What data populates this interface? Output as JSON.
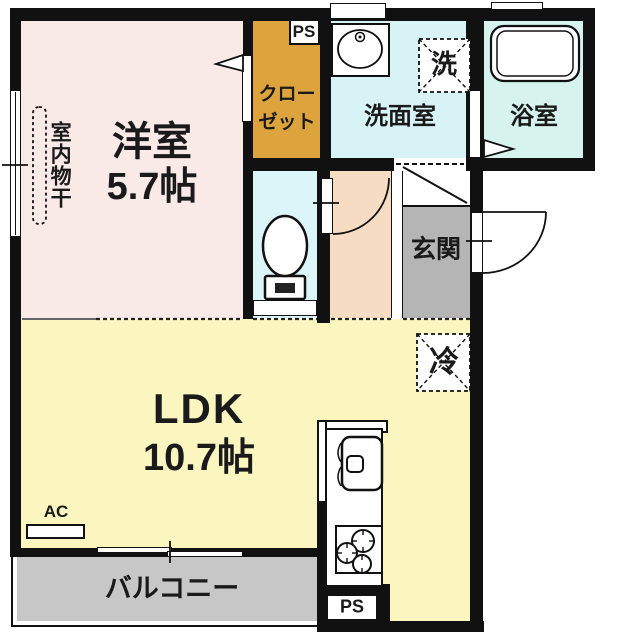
{
  "colors": {
    "wall": "#111111",
    "western-room": "#f9e9e7",
    "closet": "#dda43e",
    "toilet": "#dcf5f8",
    "hallway": "#f5dcc2",
    "entrance": "#b5b5b5",
    "washroom": "#d8f3f5",
    "bathroom": "#d7f3ee",
    "ldk": "#fbf6c0",
    "balcony": "#c7c7c7"
  },
  "plan": {
    "western_room": {
      "name": "洋室",
      "size": "5.7帖"
    },
    "indoor_drying_label": "室内物干",
    "closet": {
      "line1": "クロー",
      "line2": "ゼット"
    },
    "pipe_space_top": "PS",
    "washroom_label": "洗面室",
    "washing_machine_label": "洗",
    "bathroom_label": "浴室",
    "entrance_label": "玄関",
    "refrigerator_label": "冷",
    "ldk": {
      "name": "LDK",
      "size": "10.7帖"
    },
    "air_conditioner_label": "AC",
    "balcony_label": "バルコニー",
    "pipe_space_bottom": "PS"
  }
}
